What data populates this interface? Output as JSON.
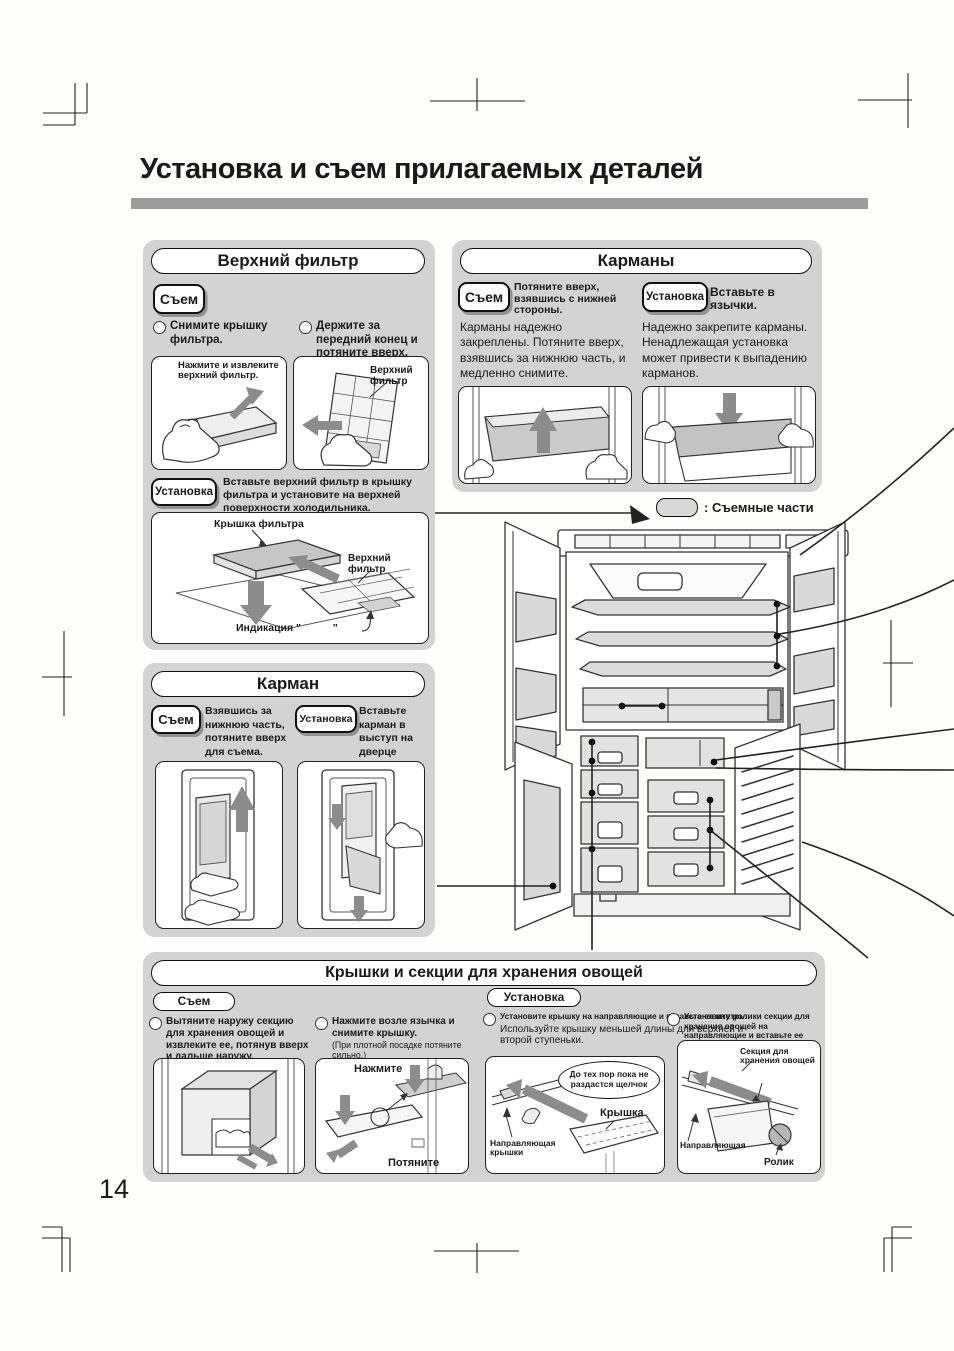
{
  "page": {
    "title": "Установка и съем прилагаемых деталей",
    "number": "14"
  },
  "colors": {
    "panel_bg": "#d3d3d3",
    "rule_gray": "#9c9c9c",
    "arrow_gray": "#8c8c8c",
    "line": "#2a2a2a"
  },
  "badges": {
    "removal": "Съем",
    "install": "Установка"
  },
  "legend": {
    "label": ": Съемные части"
  },
  "top_filter": {
    "title": "Верхний фильтр",
    "steps": [
      "Снимите крышку фильтра.",
      "Держите за передний конец и потяните вверх."
    ],
    "fig1_caption": "Нажмите и извлеките верхний фильтр.",
    "fig2_label": "Верхний фильтр",
    "install_text": "Вставьте верхний фильтр в крышку фильтра и установите на верхней поверхности холодильника.",
    "diag_cover": "Крышка фильтра",
    "diag_filter": "Верхний фильтр",
    "diag_indication": "Индикация \"",
    "diag_indication_close": "\""
  },
  "pockets": {
    "title": "Карманы",
    "removal_caption": "Потяните вверх, взявшись с нижней стороны.",
    "removal_text": "Карманы надежно закреплены. Потяните вверх, взявшись за нижнюю часть, и медленно снимите.",
    "install_caption": "Вставьте в язычки.",
    "install_text": "Надежно закрепите карманы. Ненадлежащая установка может привести к выпадению карманов."
  },
  "pocket": {
    "title": "Карман",
    "removal_caption": "Взявшись за нижнюю часть, потяните вверх для съема.",
    "install_caption": "Вставьте карман в выступ на дверце"
  },
  "veg": {
    "title": "Крышки и секции для хранения овощей",
    "removal_label": "Съем",
    "install_label": "Установка",
    "step1": "Вытяните наружу секцию для хранения овощей и извлеките ее, потянув вверх и дальше наружу.",
    "step2": "Нажмите возле язычка и снимите крышку.",
    "step2_note": "(При плотной посадке потяните сильно.)",
    "fig2_press": "Нажмите",
    "fig2_pull": "Потяните",
    "step3": "Установите крышку на направляющие и вставьте ее внутрь.",
    "step3_more": "Используйте крышку меньшей длины для верхней и второй ступеньки.",
    "fig3_bubble": "До тех пор пока не раздастся щелчок",
    "fig3_cover": "Крышка",
    "fig3_guide": "Направляющая крышки",
    "step4": "Установите ролики секции для хранения овощей на направляющие и вставьте ее внутрь.",
    "fig4_section": "Секция для хранения овощей",
    "fig4_guide": "Направляющая",
    "fig4_roller": "Ролик"
  }
}
